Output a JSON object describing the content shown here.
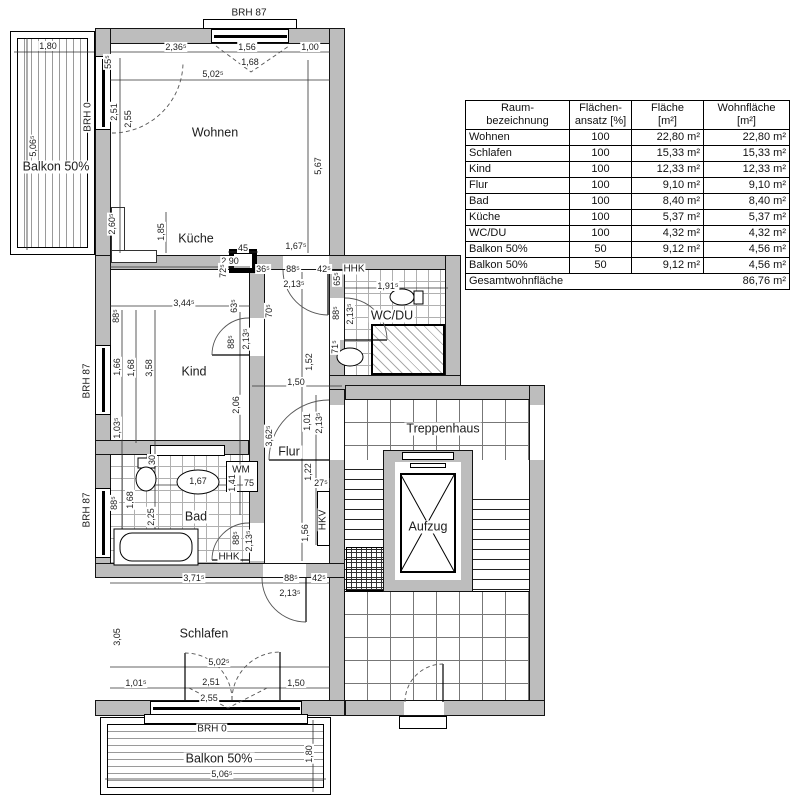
{
  "table": {
    "headers": [
      {
        "l1": "Raum-",
        "l2": "bezeichnung"
      },
      {
        "l1": "Flächen-",
        "l2": "ansatz [%]"
      },
      {
        "l1": "Fläche",
        "l2": "[m²]"
      },
      {
        "l1": "Wohnfläche",
        "l2": "[m²]"
      }
    ],
    "rows": [
      [
        "Wohnen",
        "100",
        "22,80 m²",
        "22,80 m²"
      ],
      [
        "Schlafen",
        "100",
        "15,33 m²",
        "15,33 m²"
      ],
      [
        "Kind",
        "100",
        "12,33 m²",
        "12,33 m²"
      ],
      [
        "Flur",
        "100",
        "9,10 m²",
        "9,10 m²"
      ],
      [
        "Bad",
        "100",
        "8,40 m²",
        "8,40 m²"
      ],
      [
        "Küche",
        "100",
        "5,37 m²",
        "5,37 m²"
      ],
      [
        "WC/DU",
        "100",
        "4,32 m²",
        "4,32 m²"
      ],
      [
        "Balkon 50%",
        "50",
        "9,12 m²",
        "4,56 m²"
      ],
      [
        "Balkon 50%",
        "50",
        "9,12 m²",
        "4,56 m²"
      ]
    ],
    "footer": {
      "label": "Gesamtwohnfläche",
      "value": "86,76 m²"
    }
  },
  "labels": [
    {
      "n": "room-label-wohnen",
      "t": "Wohnen",
      "x": 215,
      "y": 133,
      "k": "room"
    },
    {
      "n": "room-label-kueche",
      "t": "Küche",
      "x": 196,
      "y": 239,
      "k": "room"
    },
    {
      "n": "room-label-kind",
      "t": "Kind",
      "x": 194,
      "y": 372,
      "k": "room"
    },
    {
      "n": "room-label-flur",
      "t": "Flur",
      "x": 289,
      "y": 452,
      "k": "room"
    },
    {
      "n": "room-label-bad",
      "t": "Bad",
      "x": 196,
      "y": 517,
      "k": "room"
    },
    {
      "n": "room-label-schlafen",
      "t": "Schlafen",
      "x": 204,
      "y": 634,
      "k": "room"
    },
    {
      "n": "room-label-wcdu",
      "t": "WC/DU",
      "x": 392,
      "y": 316,
      "k": "room"
    },
    {
      "n": "room-label-treppenhaus",
      "t": "Treppenhaus",
      "x": 443,
      "y": 429,
      "k": "room"
    },
    {
      "n": "room-label-aufzug",
      "t": "Aufzug",
      "x": 428,
      "y": 527,
      "k": "room"
    },
    {
      "n": "room-label-balkon-left",
      "t": "Balkon 50%",
      "x": 56,
      "y": 167,
      "k": "room"
    },
    {
      "n": "room-label-balkon-bottom",
      "t": "Balkon 50%",
      "x": 219,
      "y": 759,
      "k": "room"
    },
    {
      "n": "annotation-brh87-top",
      "t": "BRH 87",
      "x": 249,
      "y": 13,
      "k": "ann"
    },
    {
      "n": "annotation-brh0-left",
      "t": "BRH 0",
      "x": 88,
      "y": 117,
      "r": 1,
      "k": "ann"
    },
    {
      "n": "annotation-brh87-left-1",
      "t": "BRH 87",
      "x": 87,
      "y": 381,
      "r": 1,
      "k": "ann"
    },
    {
      "n": "annotation-brh87-left-2",
      "t": "BRH 87",
      "x": 87,
      "y": 510,
      "r": 1,
      "k": "ann"
    },
    {
      "n": "annotation-brh0-bottom",
      "t": "BRH 0",
      "x": 212,
      "y": 729,
      "k": "ann"
    },
    {
      "n": "annotation-hhk-wc",
      "t": "HHK",
      "x": 354,
      "y": 269,
      "k": "ann"
    },
    {
      "n": "annotation-hhk-bad",
      "t": "HHK",
      "x": 229,
      "y": 557,
      "k": "ann"
    },
    {
      "n": "annotation-wm",
      "t": "WM",
      "x": 241,
      "y": 470,
      "k": "ann"
    },
    {
      "n": "annotation-hkv",
      "t": "HKV",
      "x": 323,
      "y": 520,
      "r": 1,
      "k": "ann"
    }
  ],
  "dims": [
    {
      "t": "1,80",
      "x": 48,
      "y": 46
    },
    {
      "t": "2,36⁵",
      "x": 176,
      "y": 47
    },
    {
      "t": "1,56",
      "x": 247,
      "y": 47
    },
    {
      "t": "1,00",
      "x": 310,
      "y": 47
    },
    {
      "t": "1,68",
      "x": 250,
      "y": 62
    },
    {
      "t": "5,02⁵",
      "x": 213,
      "y": 74
    },
    {
      "t": "55⁵",
      "x": 108,
      "y": 62,
      "r": 1
    },
    {
      "t": "2,51",
      "x": 114,
      "y": 112,
      "r": 1
    },
    {
      "t": "2,55",
      "x": 128,
      "y": 119,
      "r": 1
    },
    {
      "t": "5,06⁵",
      "x": 33,
      "y": 146,
      "r": 1
    },
    {
      "t": "5,67",
      "x": 318,
      "y": 166,
      "r": 1
    },
    {
      "t": "2,60⁵",
      "x": 112,
      "y": 224,
      "r": 1
    },
    {
      "t": "1,85",
      "x": 161,
      "y": 232,
      "r": 1
    },
    {
      "t": "2,90",
      "x": 230,
      "y": 261
    },
    {
      "t": "45",
      "x": 243,
      "y": 248
    },
    {
      "t": "72⁵",
      "x": 223,
      "y": 271,
      "r": 1
    },
    {
      "t": "36⁵",
      "x": 263,
      "y": 269
    },
    {
      "t": "88⁵",
      "x": 293,
      "y": 269
    },
    {
      "t": "42⁵",
      "x": 324,
      "y": 269
    },
    {
      "t": "1,67⁵",
      "x": 296,
      "y": 246
    },
    {
      "t": "2,13⁵",
      "x": 294,
      "y": 284
    },
    {
      "t": "1,91⁵",
      "x": 388,
      "y": 286
    },
    {
      "t": "65⁵",
      "x": 337,
      "y": 279,
      "r": 1
    },
    {
      "t": "88⁵",
      "x": 336,
      "y": 313,
      "r": 1
    },
    {
      "t": "2,13⁵",
      "x": 350,
      "y": 314,
      "r": 1
    },
    {
      "t": "71⁵",
      "x": 335,
      "y": 347,
      "r": 1
    },
    {
      "t": "3,44⁵",
      "x": 184,
      "y": 303
    },
    {
      "t": "88⁵",
      "x": 116,
      "y": 316,
      "r": 1
    },
    {
      "t": "63⁵",
      "x": 234,
      "y": 306,
      "r": 1
    },
    {
      "t": "70⁵",
      "x": 269,
      "y": 311,
      "r": 1
    },
    {
      "t": "88⁵",
      "x": 231,
      "y": 342,
      "r": 1
    },
    {
      "t": "2,13⁵",
      "x": 246,
      "y": 339,
      "r": 1
    },
    {
      "t": "1,66",
      "x": 117,
      "y": 367,
      "r": 1
    },
    {
      "t": "1,68",
      "x": 131,
      "y": 368,
      "r": 1
    },
    {
      "t": "3,58",
      "x": 149,
      "y": 368,
      "r": 1
    },
    {
      "t": "2,06",
      "x": 236,
      "y": 405,
      "r": 1
    },
    {
      "t": "1,03⁵",
      "x": 117,
      "y": 428,
      "r": 1
    },
    {
      "t": "1,52",
      "x": 309,
      "y": 362,
      "r": 1
    },
    {
      "t": "1,50",
      "x": 296,
      "y": 382
    },
    {
      "t": "3,62⁵",
      "x": 269,
      "y": 436,
      "r": 1
    },
    {
      "t": "1,01",
      "x": 307,
      "y": 422,
      "r": 1
    },
    {
      "t": "2,13⁵",
      "x": 319,
      "y": 423,
      "r": 1
    },
    {
      "t": "1,22",
      "x": 308,
      "y": 472,
      "r": 1
    },
    {
      "t": "27⁵",
      "x": 321,
      "y": 483
    },
    {
      "t": "1,56",
      "x": 305,
      "y": 533,
      "r": 1
    },
    {
      "t": "30",
      "x": 152,
      "y": 460,
      "r": 1
    },
    {
      "t": "88⁵",
      "x": 114,
      "y": 503,
      "r": 1
    },
    {
      "t": "1,68",
      "x": 130,
      "y": 500,
      "r": 1
    },
    {
      "t": "2,25",
      "x": 151,
      "y": 517,
      "r": 1
    },
    {
      "t": "1,67",
      "x": 198,
      "y": 481
    },
    {
      "t": "1,41",
      "x": 232,
      "y": 483,
      "r": 1
    },
    {
      "t": "75",
      "x": 249,
      "y": 483
    },
    {
      "t": "88⁵",
      "x": 236,
      "y": 538,
      "r": 1
    },
    {
      "t": "2,13⁵",
      "x": 249,
      "y": 541,
      "r": 1
    },
    {
      "t": "3,71⁵",
      "x": 194,
      "y": 578
    },
    {
      "t": "88⁵",
      "x": 291,
      "y": 578
    },
    {
      "t": "42⁵",
      "x": 319,
      "y": 578
    },
    {
      "t": "2,13⁵",
      "x": 290,
      "y": 593
    },
    {
      "t": "3,05",
      "x": 117,
      "y": 637,
      "r": 1
    },
    {
      "t": "5,02⁵",
      "x": 219,
      "y": 662
    },
    {
      "t": "1,01⁵",
      "x": 136,
      "y": 683
    },
    {
      "t": "2,51",
      "x": 211,
      "y": 682
    },
    {
      "t": "2,55",
      "x": 209,
      "y": 698
    },
    {
      "t": "1,50",
      "x": 296,
      "y": 683
    },
    {
      "t": "5,06⁵",
      "x": 222,
      "y": 774
    },
    {
      "t": "1,80",
      "x": 309,
      "y": 754,
      "r": 1
    }
  ]
}
